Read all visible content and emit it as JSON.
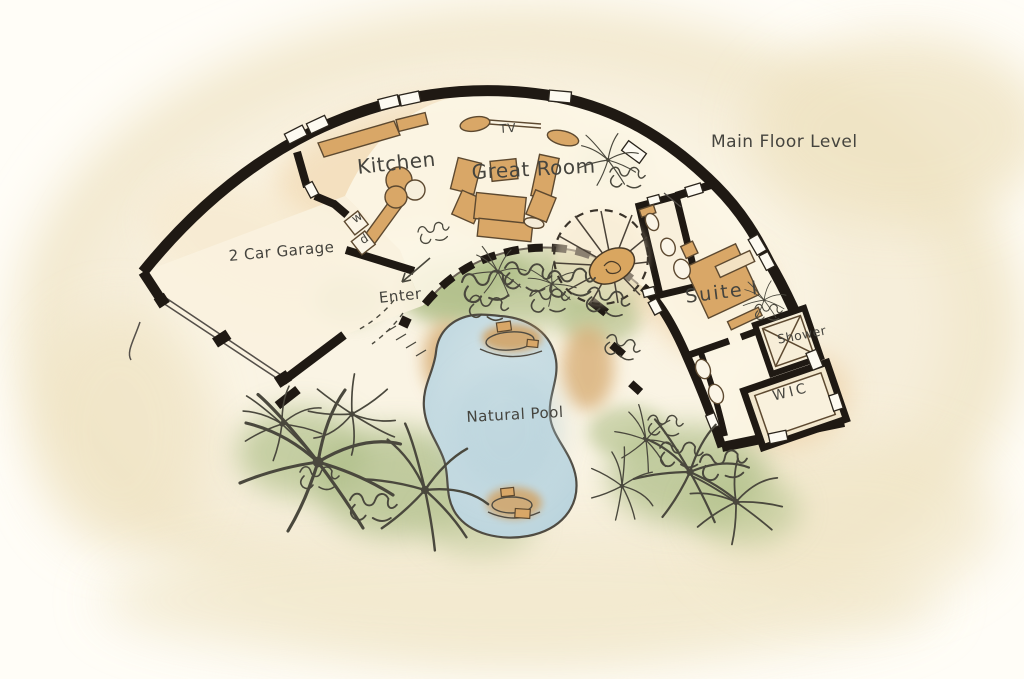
{
  "plan": {
    "title": "Main Floor Level",
    "rooms": [
      {
        "id": "kitchen",
        "label": "Kitchen"
      },
      {
        "id": "great-room",
        "label": "Great Room"
      },
      {
        "id": "garage",
        "label": "2 Car Garage"
      },
      {
        "id": "suite-1",
        "label": "Suite I"
      },
      {
        "id": "shower",
        "label": "Shower"
      },
      {
        "id": "wic",
        "label": "WIC"
      }
    ],
    "annotations": [
      {
        "id": "tv",
        "label": "TV"
      },
      {
        "id": "enter",
        "label": "Enter"
      },
      {
        "id": "natural-pool",
        "label": "Natural Pool"
      },
      {
        "id": "washer",
        "label": "w"
      },
      {
        "id": "dryer",
        "label": "d"
      }
    ],
    "colors": {
      "paper": "#f6eed8",
      "wall_ink": "#1f1913",
      "line_ink": "#4f4b42",
      "text_ink": "#45443e",
      "furniture_tan": "#d9a767",
      "wash_peach": "#f3ddb9",
      "foliage_green": "#aebd86",
      "pool_blue": "#bdd7df"
    }
  }
}
